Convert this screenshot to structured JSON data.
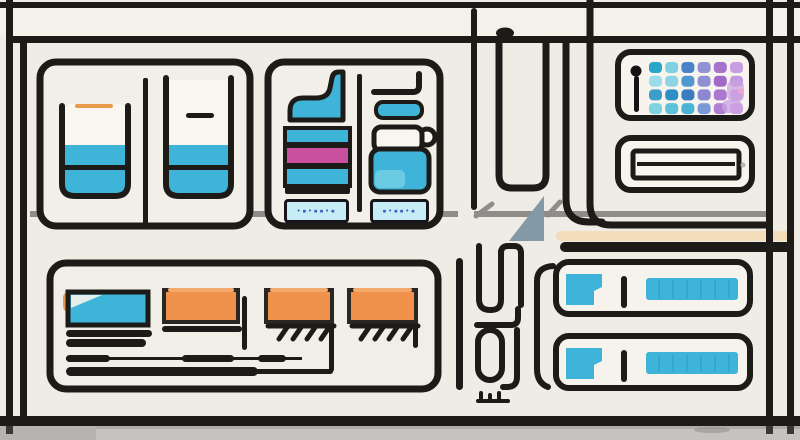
{
  "scene": {
    "description": "flat line-art illustration of a laboratory control wall with beaker cabinet, vial rack, dot display, card slot and server units",
    "background": "#efece6",
    "line_color": "#1d1b17",
    "rail_color": "#8f8d89",
    "floor_color": "#c5c3bf"
  },
  "palette": {
    "cyan": "#3eb5d8",
    "cyan_pale": "#c6edf5",
    "magenta": "#c9509e",
    "orange": "#f0924c",
    "orange_soft": "#e89a4a",
    "peach": "#f3ddbb",
    "slate": "#8399a5",
    "white_warm": "#f8f6ef",
    "glyph_blue": "#3b5bbf",
    "ridge_cyan": "#1d8fb0",
    "lavender": "#c9a0e0",
    "pink_dot": "#eba6cd"
  },
  "chips": [
    {
      "text": "•▪•▪▪•▪"
    },
    {
      "text": "▪•▪▪•▪"
    }
  ],
  "dot_grid": {
    "rows": [
      [
        "#2aa6c8",
        "#7ed0e2",
        "#4a84c8",
        "#9192d4",
        "#a873cc",
        "#c89fe2"
      ],
      [
        "#9bdcea",
        "#8fd4e4",
        "#4e98d0",
        "#8f8fd2",
        "#a369c9",
        "#c39ade"
      ],
      [
        "#3e9ecb",
        "#2f8fc4",
        "#3a7cc2",
        "#8b87d0",
        "#ab77cf",
        "#cba4e4"
      ],
      [
        "#7fd2e2",
        "#5cc2da",
        "#49b4d4",
        "#7a9ad4",
        "#b07fd2",
        "#c9a0e0"
      ]
    ]
  },
  "bottom_left_panel": {
    "blocks": [
      {
        "color": "#3eb5d8"
      },
      {
        "color": "#f0924c"
      },
      {
        "color": "#f0924c"
      },
      {
        "color": "#f0924c"
      }
    ]
  },
  "icons": [
    "pin-icon",
    "dot-grid-display",
    "card-slot-icon",
    "beaker-icon",
    "vial-icon",
    "server-unit-icon",
    "triangle-flag-icon"
  ]
}
